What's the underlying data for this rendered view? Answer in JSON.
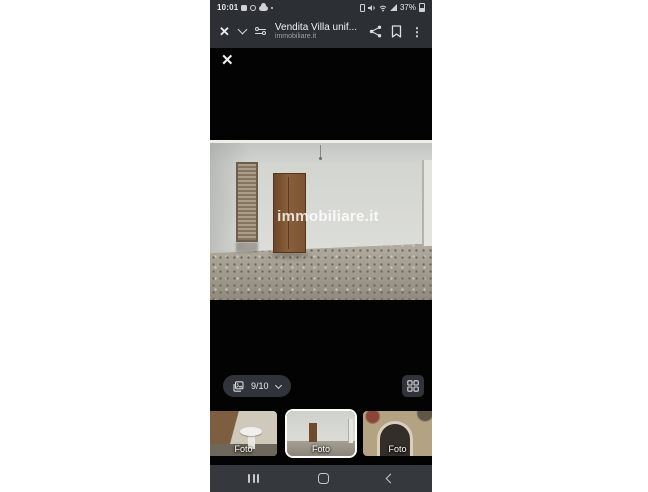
{
  "status_bar": {
    "time": "10:01",
    "battery_percent": "37%"
  },
  "app_bar": {
    "title": "Vendita Villa unif...",
    "subtitle": "immobiliare.it"
  },
  "icons": {
    "close": "✕",
    "kebab": "⋮"
  },
  "viewer": {
    "watermark": "immobiliare.it",
    "counter": "9/10"
  },
  "thumbnails": [
    {
      "label": "Foto",
      "selected": false,
      "content": "bathroom-pedestal-sink"
    },
    {
      "label": "Foto",
      "selected": true,
      "content": "empty-room-current"
    },
    {
      "label": "Foto",
      "selected": false,
      "content": "fireplace-arch"
    }
  ],
  "colors": {
    "bar_background": "#2c3034",
    "viewer_background": "#000000",
    "pill_background": "#30343a",
    "nav_background": "#35383c",
    "selected_thumb_border": "#ffffff"
  }
}
